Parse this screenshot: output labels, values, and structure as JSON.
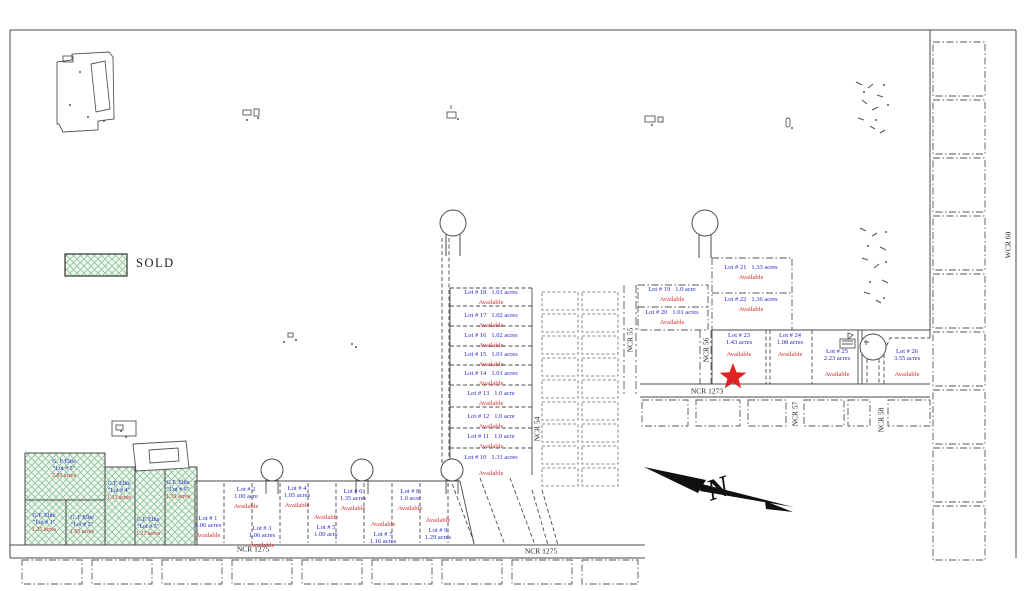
{
  "legend": {
    "sold": "SOLD"
  },
  "status": {
    "available": "Available"
  },
  "compass": {
    "north": "N"
  },
  "roads": {
    "ncr_1275_a": "NCR 1275",
    "ncr_1275_b": "NCR 1275",
    "ncr_1273": "NCR 1273",
    "ncr_54": "NCR 54",
    "ncr_55": "NCR 55",
    "ncr_56": "NCR 56",
    "ncr_57": "NCR 57",
    "ncr_58": "NCR 58",
    "wcr_60": "WCR 60"
  },
  "colors": {
    "lot_label": "#2626c4",
    "available": "#cf2e2e",
    "sold_hatch": "#8cc49a",
    "star": "#e02424",
    "line": "#4a4a4d"
  },
  "available_lots": [
    {
      "name": "Lot # 1",
      "acres": "1.06 acres"
    },
    {
      "name": "Lot # 2",
      "acres": "1.00 acre"
    },
    {
      "name": "Lot # 3",
      "acres": "1.06 acres"
    },
    {
      "name": "Lot # 4",
      "acres": "1.05 acres"
    },
    {
      "name": "Lot # 5",
      "acres": "1.00 acre"
    },
    {
      "name": "Lot # 6",
      "acres": "1.35 acres"
    },
    {
      "name": "Lot # 7",
      "acres": "1.16 acres"
    },
    {
      "name": "Lot # 8",
      "acres": "1.0 acre"
    },
    {
      "name": "Lot # 9",
      "acres": "1.29 acres"
    },
    {
      "name": "Lot # 10",
      "acres": "1.31 acres"
    },
    {
      "name": "Lot # 11",
      "acres": "1.0 acre"
    },
    {
      "name": "Lot # 12",
      "acres": "1.0 acre"
    },
    {
      "name": "Lot # 13",
      "acres": "1.0 acre"
    },
    {
      "name": "Lot # 14",
      "acres": "1.01 acres"
    },
    {
      "name": "Lot # 15",
      "acres": "1.01 acres"
    },
    {
      "name": "Lot # 16",
      "acres": "1.02 acres"
    },
    {
      "name": "Lot # 17",
      "acres": "1.02 acres"
    },
    {
      "name": "Lot # 18",
      "acres": "1.01 acres"
    },
    {
      "name": "Lot # 19",
      "acres": "1.0 acre"
    },
    {
      "name": "Lot # 20",
      "acres": "1.01 acres"
    },
    {
      "name": "Lot # 21",
      "acres": "1.33 acres"
    },
    {
      "name": "Lot # 22",
      "acres": "1.36 acres"
    },
    {
      "name": "Lot # 23",
      "acres": "1.43 acres"
    },
    {
      "name": "Lot # 24",
      "acres": "1.08 acres"
    },
    {
      "name": "Lot # 25",
      "acres": "2.23 acres"
    },
    {
      "name": "Lot # 26",
      "acres": "3.55 acres"
    }
  ],
  "sold_lots": [
    {
      "owner": "G.F. Elite",
      "lot": "\"Lot # 1\"",
      "acres": "1.25 acres"
    },
    {
      "owner": "G. F Elite",
      "lot": "\"Lot # 2\"",
      "acres": "1.03 acres"
    },
    {
      "owner": "G.F. Elite",
      "lot": "\"Lot # 3\"",
      "acres": "1.27 acres"
    },
    {
      "owner": "G.F. Elite",
      "lot": "\"Lot # 4\"",
      "acres": "1.33 acres"
    },
    {
      "owner": "G. F Elite",
      "lot": "\"Lot # 5\"",
      "acres": "2.85 acres"
    },
    {
      "owner": "G.F. Elite",
      "lot": "\"Lot # 6\"",
      "acres": "1.33 acres"
    }
  ]
}
